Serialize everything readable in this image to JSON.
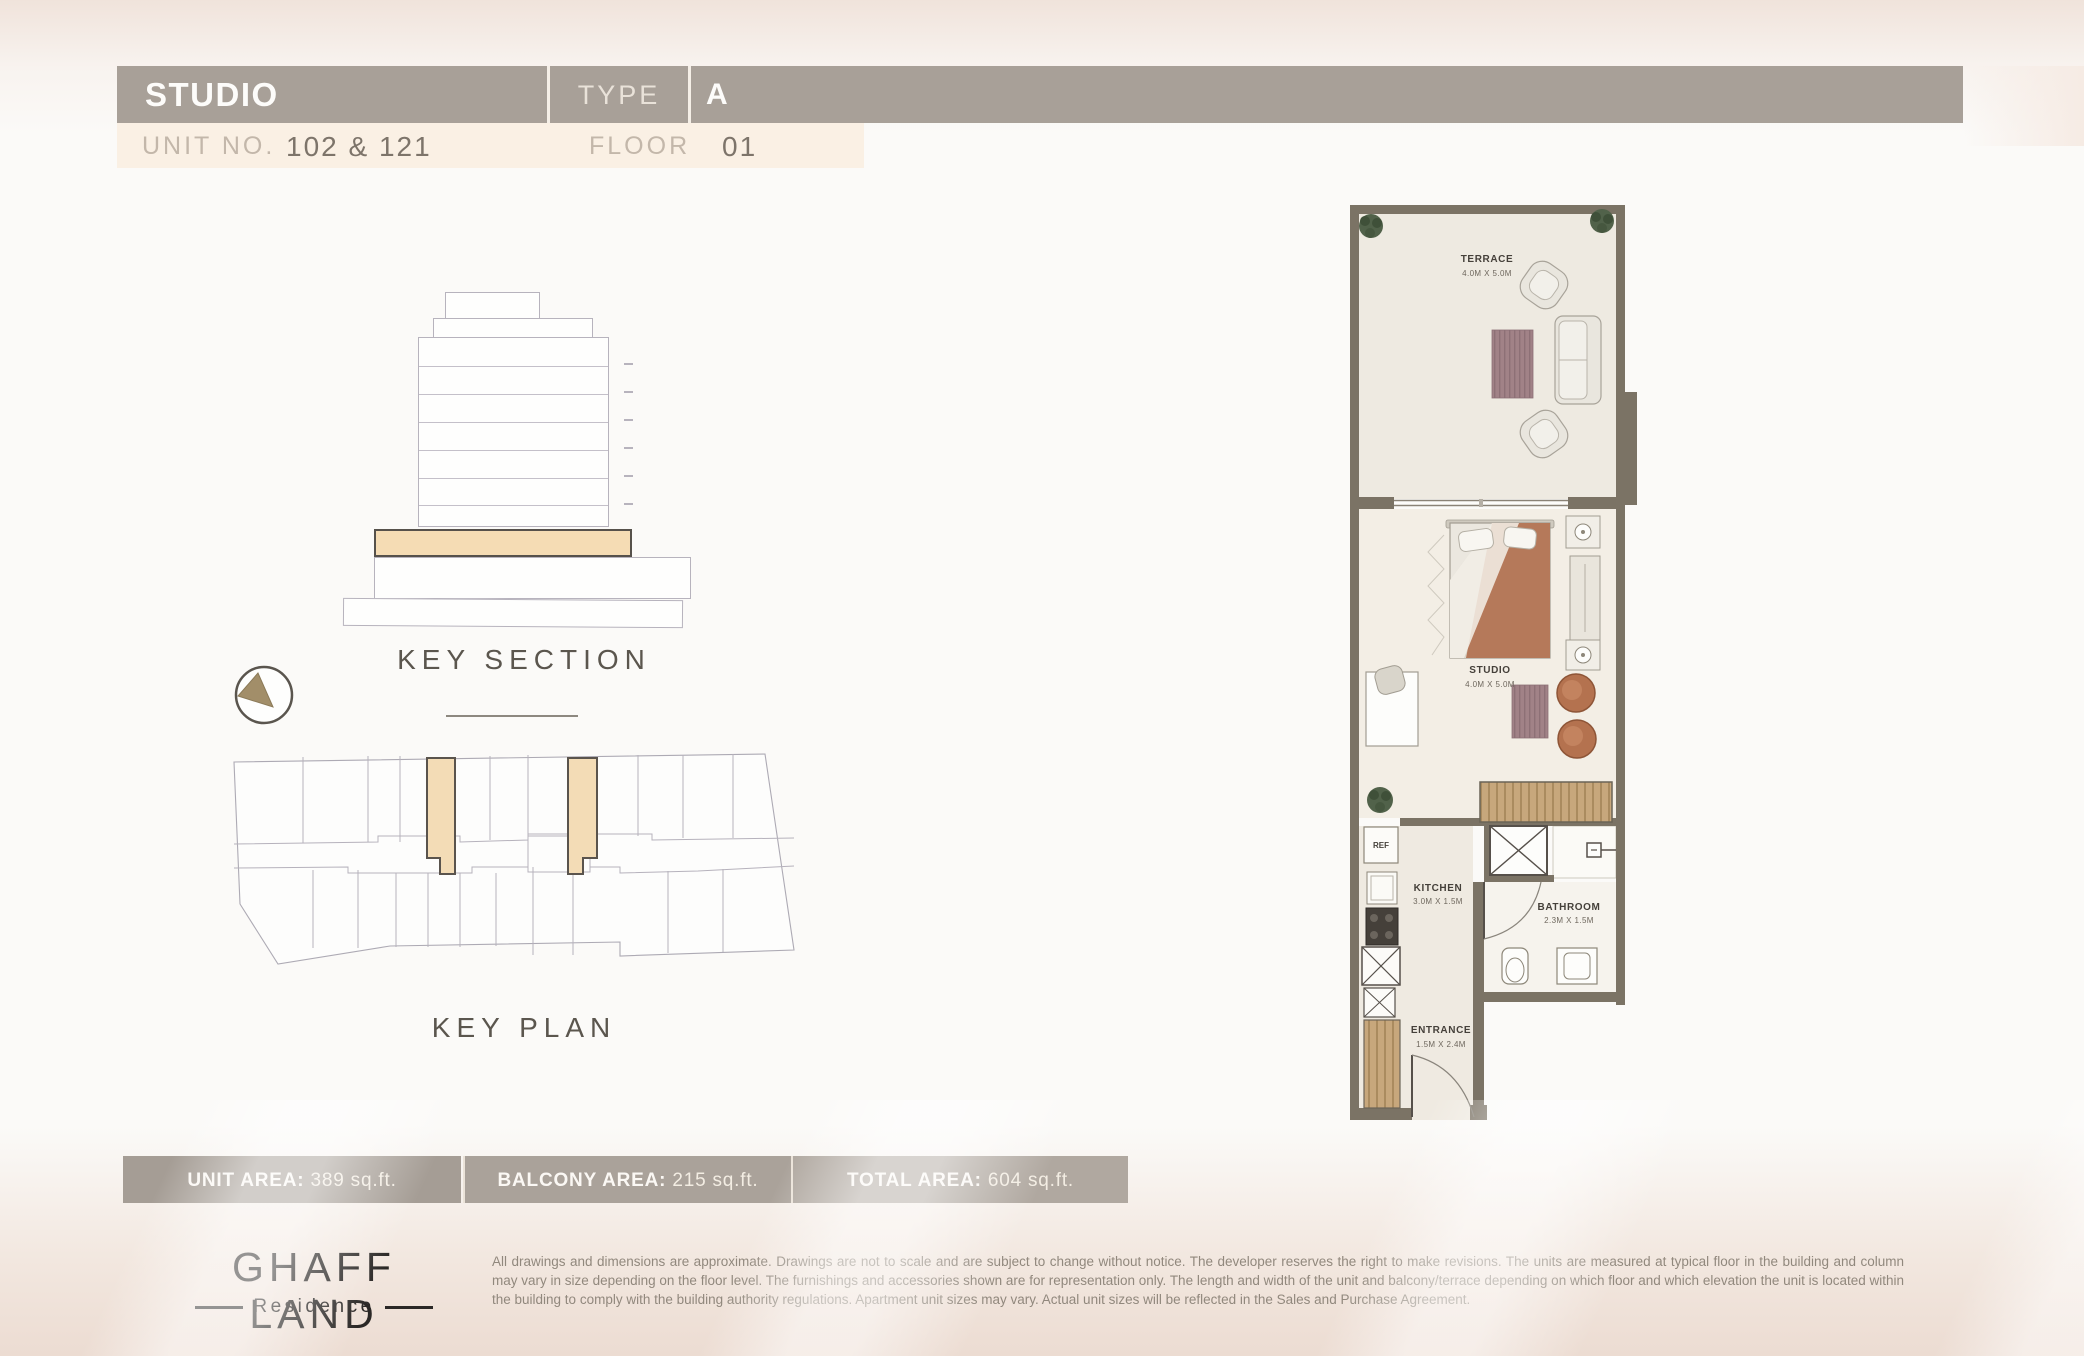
{
  "header": {
    "unit_type": "STUDIO",
    "type_label": "TYPE",
    "type_value": "A",
    "unit_no_label": "UNIT NO.",
    "unit_no_value": "102 & 121",
    "floor_label": "FLOOR",
    "floor_value": "01"
  },
  "key_section": {
    "title": "KEY SECTION"
  },
  "key_plan": {
    "title": "KEY PLAN"
  },
  "floor_plan": {
    "terrace": {
      "name": "TERRACE",
      "dims": "4.0M X 5.0M"
    },
    "studio": {
      "name": "STUDIO",
      "dims": "4.0M X 5.0M"
    },
    "kitchen": {
      "name": "KITCHEN",
      "dims": "3.0M X 1.5M"
    },
    "bathroom": {
      "name": "BATHROOM",
      "dims": "2.3M X 1.5M"
    },
    "entrance": {
      "name": "ENTRANCE",
      "dims": "1.5M X 2.4M"
    },
    "ref_label": "REF"
  },
  "areas": {
    "items": [
      {
        "label": "UNIT AREA:",
        "value": " 389 sq.ft."
      },
      {
        "label": "BALCONY AREA:",
        "value": " 215 sq.ft."
      },
      {
        "label": "TOTAL AREA:",
        "value": " 604 sq.ft."
      }
    ]
  },
  "footer": {
    "brand": "GHAFF LAND",
    "sub_brand": "Residence",
    "disclaimer": "All drawings and dimensions are approximate. Drawings are not to scale and are subject to change without notice. The developer reserves the right to make revisions. The units are measured at typical floor in the building and column may vary in size depending on the floor level. The furnishings and accessories shown are for representation only. The length and width of the unit and balcony/terrace depending on which floor and which elevation the unit is located within the building to comply with the building authority regulations. Apartment unit sizes may vary. Actual unit sizes will be reflected in the Sales and Purchase Agreement."
  },
  "colors": {
    "header_bar": "#a8a098",
    "unit_row_bg": "#faf0e4",
    "highlight": "#f5dcb4",
    "wall": "#7b7365",
    "wood": "#c7a77c",
    "terracotta": "#b4724f",
    "rug": "#a18287"
  }
}
